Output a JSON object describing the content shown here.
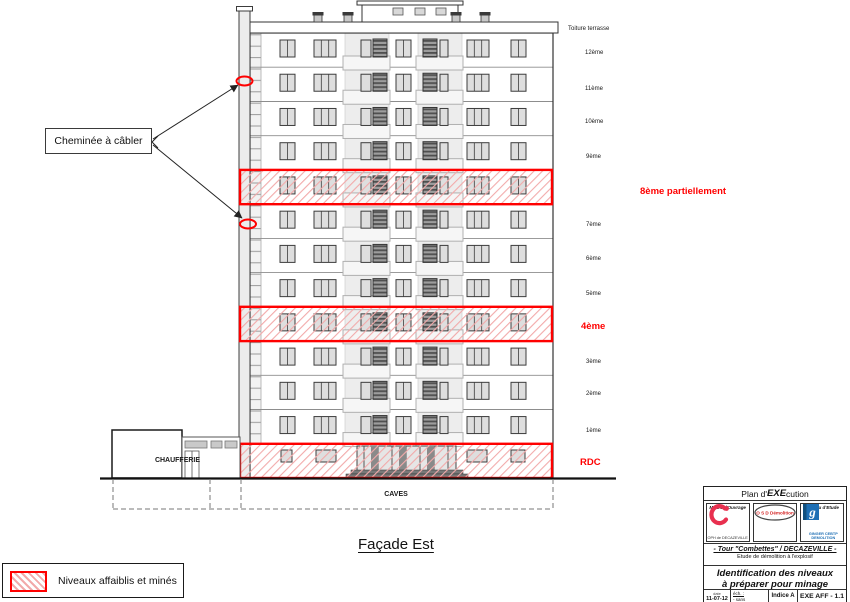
{
  "drawing": {
    "figure_title": "Façade Est",
    "roof_label": "Toiture terrasse",
    "chimney_note": "Cheminée à câbler",
    "chaufferie_label": "CHAUFFERIE",
    "caves_label": "CAVES"
  },
  "levels": [
    {
      "label": "12ème",
      "highlight": false
    },
    {
      "label": "11ème",
      "highlight": false
    },
    {
      "label": "10ème",
      "highlight": false
    },
    {
      "label": "9ème",
      "highlight": false
    },
    {
      "label": "8ème partiellement",
      "highlight": true
    },
    {
      "label": "7ème",
      "highlight": false
    },
    {
      "label": "6ème",
      "highlight": false
    },
    {
      "label": "5ème",
      "highlight": false
    },
    {
      "label": "4ème",
      "highlight": true
    },
    {
      "label": "3ème",
      "highlight": false
    },
    {
      "label": "2ème",
      "highlight": false
    },
    {
      "label": "1ème",
      "highlight": false
    },
    {
      "label": "RDC",
      "highlight": true
    }
  ],
  "legend": {
    "text": "Niveaux affaiblis et minés"
  },
  "colors": {
    "highlight_red": "#ff0000",
    "hatch_pink": "#f2aaaa",
    "oph_red": "#e8304f",
    "osd_red": "#d42222",
    "ginger_blue": "#1e6fb4"
  },
  "title_block": {
    "plan_prefix": "Plan d'",
    "plan_bold": "EXE",
    "plan_suffix": "cution",
    "columns": [
      {
        "role": "Maître d'Ouvrage",
        "org": "OPH de DECAZEVILLE"
      },
      {
        "role": "Entreprise",
        "org": "O S D  Démolition"
      },
      {
        "role": "Bureau d'Etude",
        "org_line1": "GINGER CEBTP",
        "org_line2": "DEMOLITION"
      }
    ],
    "project_line1": "- Tour \"Combettes\" / DECAZEVILLE -",
    "project_line2": "Etude de démolition à l'explosif",
    "doc_title_line1": "Identification des niveaux",
    "doc_title_line2": "à préparer pour minage",
    "meta": {
      "date_label": "date",
      "date_value": "11-07-12",
      "scale_label": "éch. :",
      "scale_value": "- sans",
      "indice": "Indice A",
      "ref": "EXE AFF - 1.1"
    }
  }
}
